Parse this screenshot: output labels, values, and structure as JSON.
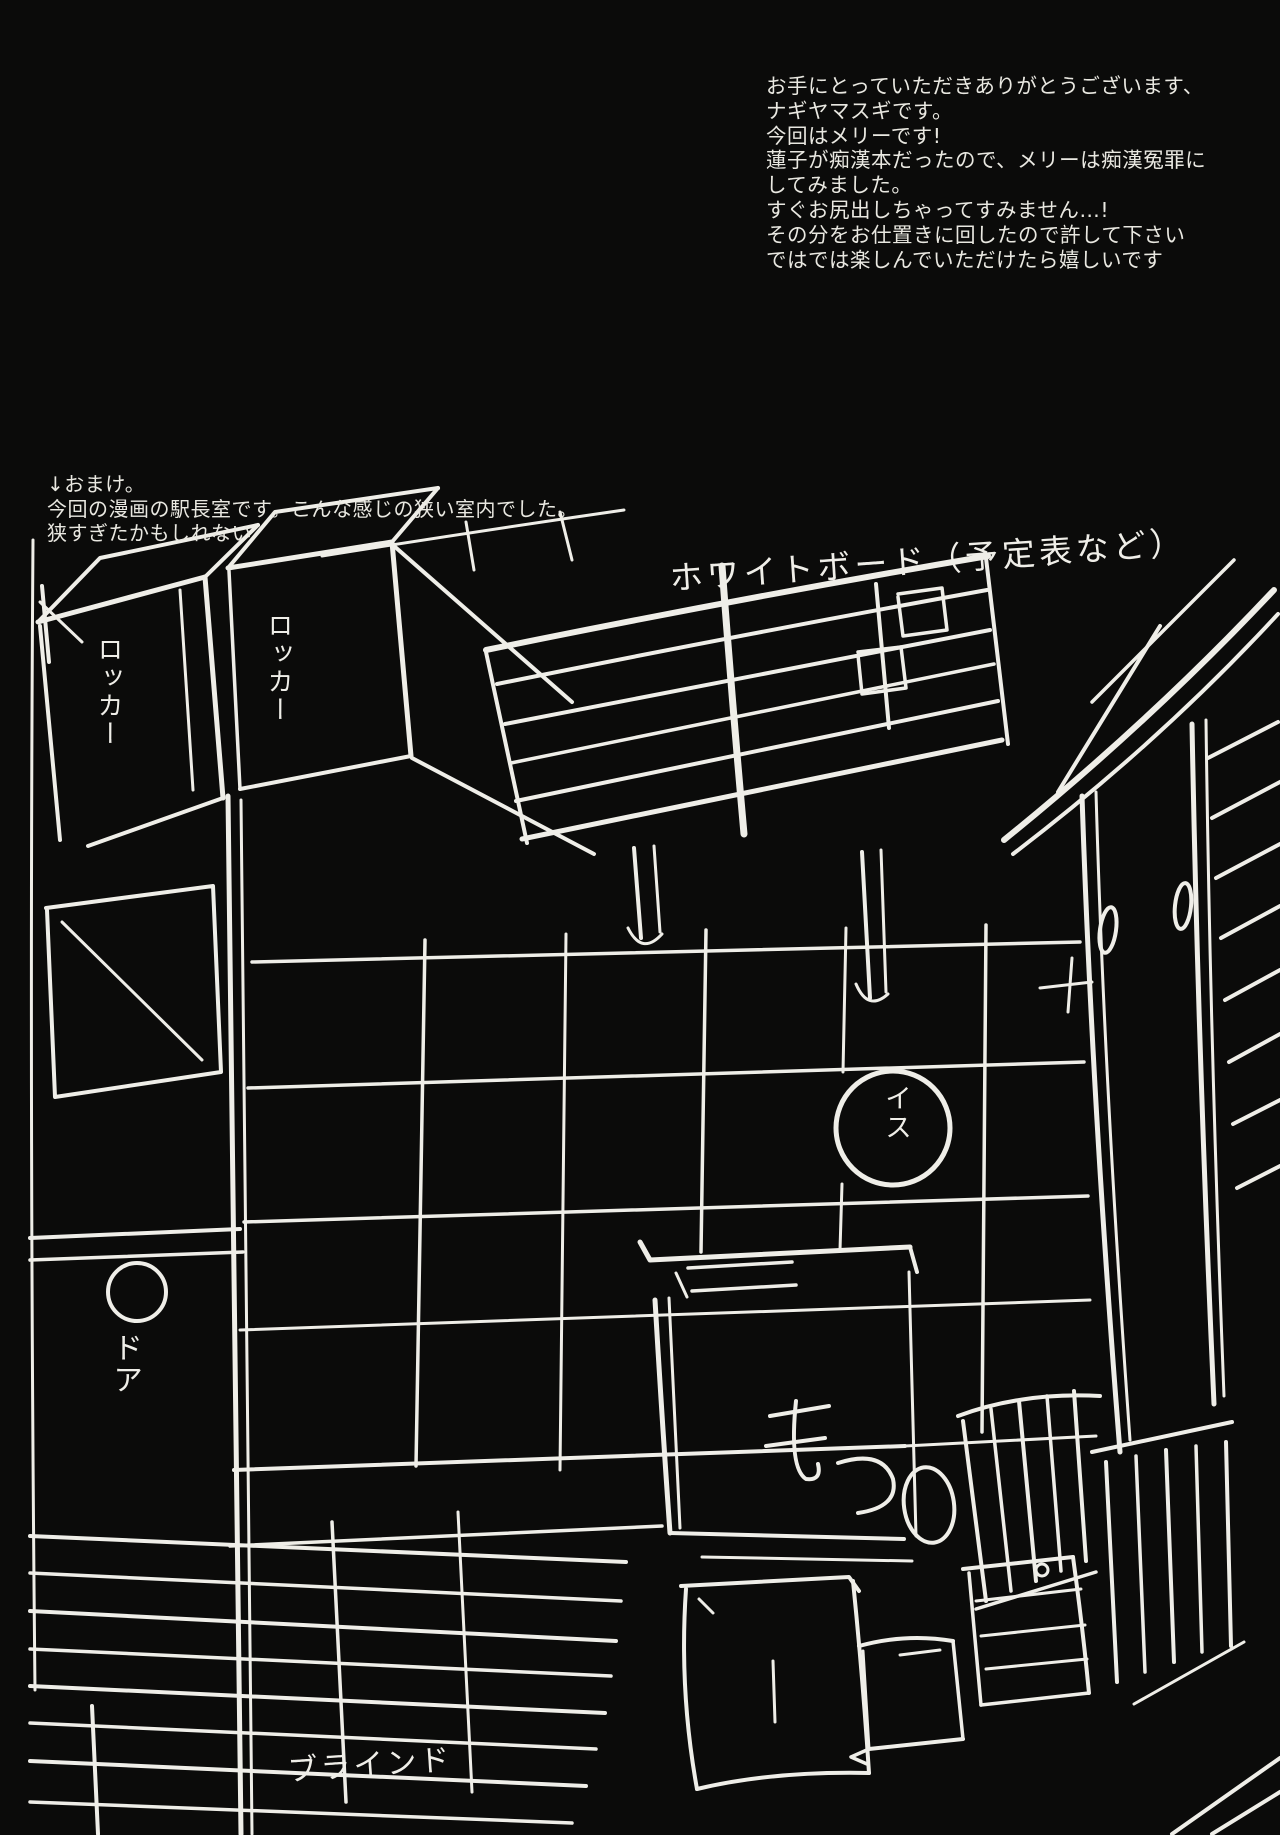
{
  "page": {
    "background": "#0b0b0a",
    "ink": "#efeee8"
  },
  "afterword": {
    "lines": [
      "お手にとっていただきありがとうございます、",
      "ナギヤマスギです。",
      "今回はメリーです!",
      "蓮子が痴漢本だったので、メリーは痴漢冤罪に",
      "してみました。",
      "すぐお尻出しちゃってすみません…!",
      "その分をお仕置きに回したので許して下さい",
      "ではでは楽しんでいただけたら嬉しいです"
    ]
  },
  "omake": {
    "lines": [
      "↓おまけ。",
      "今回の漫画の駅長室です。こんな感じの狭い室内でした。",
      "狭すぎたかもしれない"
    ]
  },
  "sketch_labels": {
    "whiteboard": "ホワイトボード（予定表など）",
    "locker_left": "ロッカー",
    "locker_right": "ロッカー",
    "door": "ドア",
    "chair": "イス",
    "blinds": "ブラインド"
  }
}
